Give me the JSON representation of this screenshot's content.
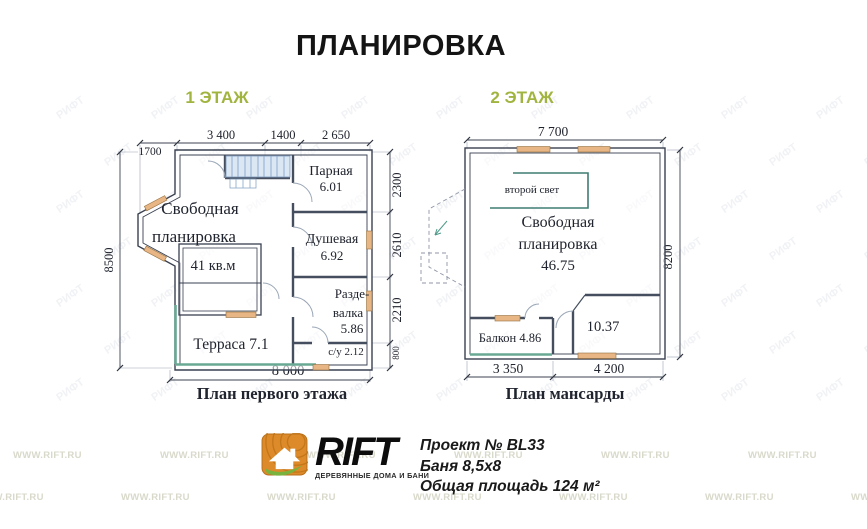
{
  "title": "ПЛАНИРОВКА",
  "watermark": "WWW.RIFT.RU",
  "stamp": "РИФТ",
  "colors": {
    "accent_green": "#a2b440",
    "window_mark": "#e8b584",
    "terrace_edge": "#69a893",
    "railing": "#3f7d74",
    "logo_orange": "#dd8a2a",
    "logo_leaf": "#79b33e",
    "stairs_fill": "#dbe7f3"
  },
  "floors": {
    "f1": {
      "label": "1 ЭТАЖ",
      "caption": "План первого этажа",
      "dims": {
        "d1700": "1700",
        "d3400": "3 400",
        "d1400": "1400",
        "d2650": "2 650",
        "d8500": "8500",
        "d2300": "2300",
        "d2610": "2610",
        "d2210": "2210",
        "d800": "800",
        "d8000": "8 000"
      },
      "rooms": {
        "free1": "Свободная",
        "free2": "планировка",
        "free_area": "41 кв.м",
        "parnaya": "Парная",
        "parnaya_area": "6.01",
        "dush": "Душевая",
        "dush_area": "6.92",
        "razde1": "Разде-",
        "razde2": "валка",
        "razde_area": "5.86",
        "su": "с/у  2.12",
        "terrace": "Терраса 7.1"
      }
    },
    "f2": {
      "label": "2 ЭТАЖ",
      "caption": "План мансарды",
      "dims": {
        "d7700": "7 700",
        "d8200": "8200",
        "d3350": "3 350",
        "d4200": "4 200"
      },
      "rooms": {
        "second_light": "второй свет",
        "free1": "Свободная",
        "free2": "планировка",
        "free_area": "46.75",
        "balcony": "Балкон 4.86",
        "room_area": "10.37"
      }
    }
  },
  "footer": {
    "brand": "RIFT",
    "tagline": "ДЕРЕВЯННЫЕ ДОМА И БАНИ",
    "project": "Проект № BL33",
    "building": "Баня 8,5x8",
    "area_total": "Общая площадь 124 м²"
  }
}
